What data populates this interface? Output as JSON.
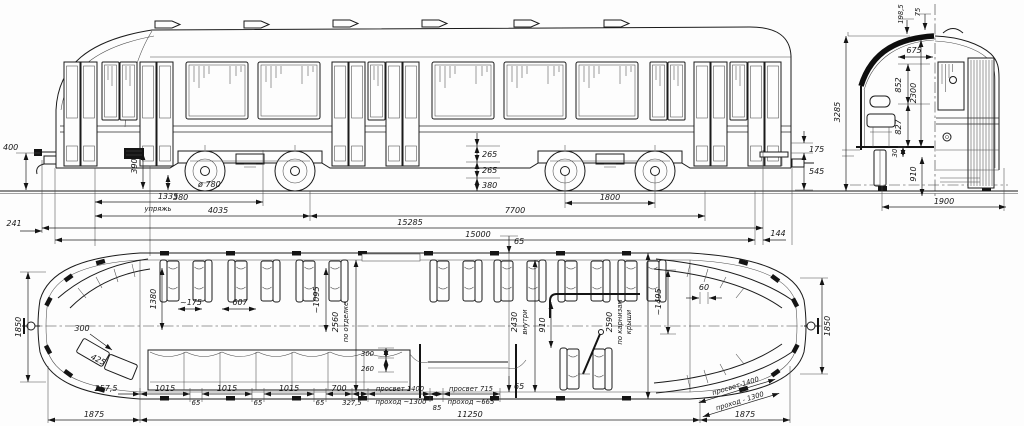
{
  "dims": {
    "side": {
      "v400": "400",
      "v241": "241",
      "harness_len": "1335",
      "harness": "упряжь",
      "v390": "390",
      "axle_low": "380",
      "wheel_d": "ø 780",
      "bogie_offset": "4035",
      "bogie_base": "7700",
      "len_over": "15285",
      "len_body": "15000",
      "wheelbase": "1800",
      "c265a": "265",
      "c265b": "265",
      "c380": "380",
      "r175": "175",
      "r545": "545",
      "r144": "144"
    },
    "end": {
      "t198": "198,5",
      "t75": "75",
      "w675": "675",
      "h852": "852",
      "h2300": "2300",
      "h827": "827",
      "h30": "30",
      "h910": "910",
      "total_h": "3285",
      "w1900": "1900"
    },
    "plan": {
      "wl1850": "1850",
      "wr1850": "1850",
      "l300": "300",
      "l425": "425",
      "p1380": "1380",
      "p175": "~175",
      "p607": "607",
      "w2560": "2560",
      "w2560l": "по отделке",
      "p1095": "~1095",
      "t65": "65",
      "w2430": "2430",
      "w2430l": "внутри",
      "p910": "910",
      "w2590": "2590",
      "w2590l1": "по карнизам",
      "w2590l2": "крыши",
      "p1495": "~1495",
      "p60": "60",
      "b65": "65",
      "s257": "257,5",
      "s1015a": "1015",
      "s65a": "65",
      "s1015b": "1015",
      "s65b": "65",
      "s1015c": "1015",
      "s65c": "65",
      "s700": "700",
      "s327": "327,5",
      "gap1": "просвет 1400",
      "gap1b": "проход ~1300",
      "s85": "85",
      "gap2": "просвет 715",
      "gap2b": "проход ~665",
      "d300": "300",
      "d260": "260",
      "total": "11250",
      "e1875l": "1875",
      "e1875r": "1875",
      "diag1": "просвет-1400",
      "diag2": "проход - 1300"
    }
  }
}
